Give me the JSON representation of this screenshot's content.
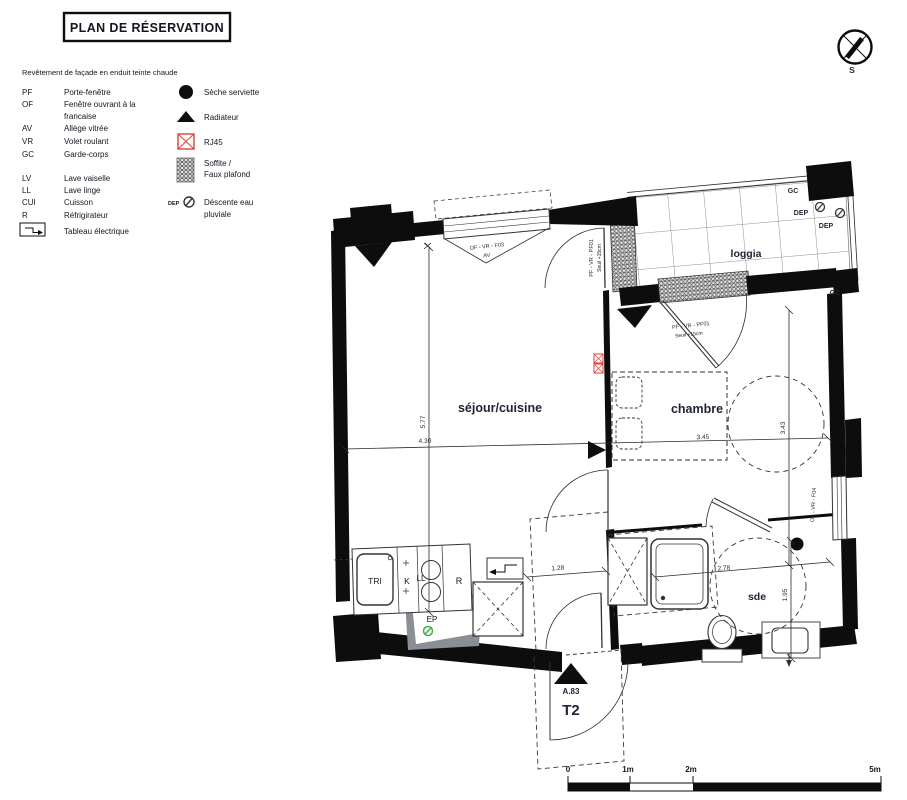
{
  "title": "PLAN DE RÉSERVATION",
  "facade_note": "Revêtement de façade en enduit teinte chaude",
  "legend": {
    "abbreviations": [
      {
        "abbr": "PF",
        "label": "Porte-fenêtre"
      },
      {
        "abbr": "OF",
        "label": "Fenêtre ouvrant à la",
        "label2": "francaise"
      },
      {
        "abbr": "AV",
        "label": "Allège vitrée"
      },
      {
        "abbr": "VR",
        "label": "Volet roulant"
      },
      {
        "abbr": "GC",
        "label": "Garde-corps"
      },
      {
        "abbr": "LV",
        "label": "Lave vaiselle"
      },
      {
        "abbr": "LL",
        "label": "Lave linge"
      },
      {
        "abbr": "CUI",
        "label": "Cuisson"
      },
      {
        "abbr": "R",
        "label": "Réfrigirateur"
      },
      {
        "abbr": "",
        "label": "Tableau électrique"
      }
    ],
    "symbols": [
      {
        "name": "seche-serviette",
        "label": "Sèche serviette"
      },
      {
        "name": "radiateur",
        "label": "Radiateur"
      },
      {
        "name": "rj45",
        "label": "RJ45"
      },
      {
        "name": "soffite",
        "label": "Soffite /",
        "label2": "Faux plafond"
      },
      {
        "name": "descente-eau",
        "abbr": "DEP",
        "label": "Déscente eau",
        "label2": "pluviale"
      }
    ]
  },
  "compass": {
    "south_label": "S"
  },
  "plan": {
    "rooms": {
      "sejour": "séjour/cuisine",
      "chambre": "chambre",
      "loggia": "loggia",
      "sde": "sde"
    },
    "openings": {
      "window_f03": "OF - VR - F03",
      "window_f03_av": "AV",
      "door_loggia_sejour": "PF - VR - PF01",
      "door_loggia_sejour_seuil": "Seuil +15cm",
      "door_loggia_chambre": "PF - VR - PF01",
      "door_loggia_chambre_seuil": "Seuil +15cm",
      "window_f04": "OF - VR - F04"
    },
    "annotations": {
      "gc_top": "GC",
      "gc_right": "GC",
      "dep1": "DEP",
      "dep2": "DEP",
      "ep": "EP",
      "tri": "TRI",
      "k": "K",
      "ll": "LL",
      "r": "R"
    },
    "dimensions": {
      "sejour_w": "4.30",
      "sejour_h": "5.77",
      "chambre_w": "3.45",
      "chambre_h": "3.43",
      "hall_w": "1.28",
      "sde_w": "2.78",
      "sde_h": "1.95"
    },
    "unit": {
      "ref": "A.83",
      "type": "T2"
    }
  },
  "scalebar": {
    "t0": "0",
    "t1": "1m",
    "t2": "2m",
    "t5": "5m"
  },
  "colors": {
    "ink": "#0d0d0d",
    "label": "#1f2433",
    "rj45_red": "#e04038",
    "ep_green": "#3fae49",
    "shade_gray": "#8a8f96"
  }
}
